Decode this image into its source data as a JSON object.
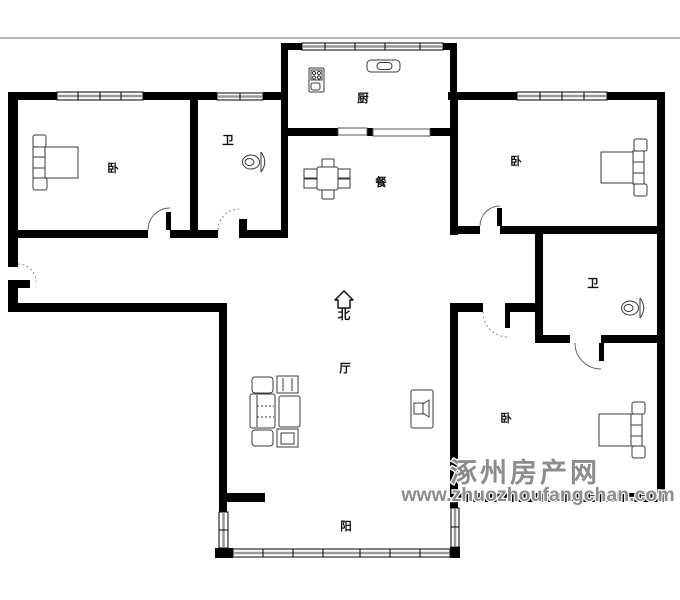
{
  "colors": {
    "wall": "#000000",
    "watermark": "#8c8c8c",
    "frame_line": "#b4b4b4"
  },
  "compass": {
    "north_label": "北"
  },
  "rooms": {
    "bedroom_top_left": {
      "label": "卧"
    },
    "bathroom_top": {
      "label": "卫"
    },
    "kitchen": {
      "label": "厨"
    },
    "dining": {
      "label": "餐"
    },
    "bedroom_top_right": {
      "label": "卧"
    },
    "bathroom_right": {
      "label": "卫"
    },
    "living": {
      "label": "厅"
    },
    "bedroom_bottom_right": {
      "label": "卧"
    },
    "balcony": {
      "label": "阳"
    }
  },
  "watermark": {
    "site_name": "涿州房产网",
    "site_url": "www.zhuozhoufangchan.com"
  }
}
